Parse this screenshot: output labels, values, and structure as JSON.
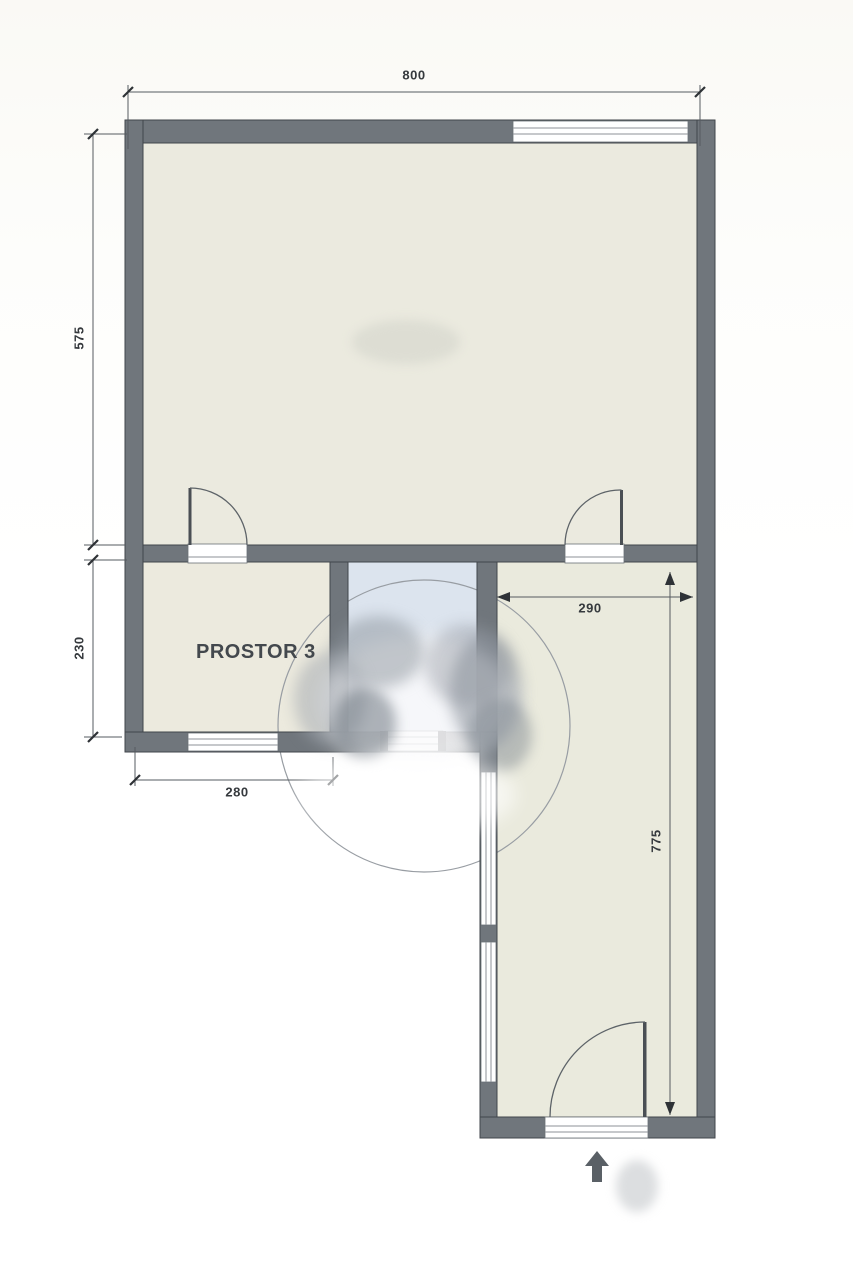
{
  "plan": {
    "room_labels": {
      "prostor3": "PROSTOR 3"
    },
    "dimensions": {
      "top_width": "800",
      "upper_left_height": "575",
      "lower_left_height": "230",
      "bottom_left_width": "280",
      "right_room_width": "290",
      "right_room_height": "775"
    },
    "icons": {
      "entrance_arrow": "arrow-up"
    },
    "colors": {
      "wall": "#70767c",
      "wall_outline": "#41464b",
      "floor": "#ebeadf",
      "bathroom_floor": "#dce4ee",
      "dimension_line": "#565b60",
      "dimension_text": "#35393d",
      "background": "#ffffff"
    }
  }
}
